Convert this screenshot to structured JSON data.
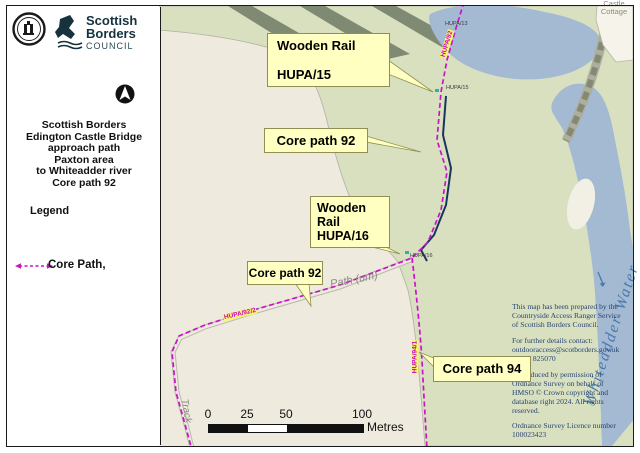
{
  "left_panel": {
    "logo": {
      "line1": "Scottish",
      "line2": "Borders",
      "council": "COUNCIL"
    },
    "title_lines": [
      "Scottish Borders",
      "Edington Castle Bridge",
      "approach path",
      "Paxton area",
      "to Whiteadder  river",
      "Core path 92"
    ],
    "legend_heading": "Legend",
    "legend_core_path_label": "Core Path,"
  },
  "map": {
    "callouts": {
      "wooden_rail_15": {
        "line1": "Wooden Rail",
        "line2": "HUPA/15"
      },
      "core_path_92_upper": {
        "label": "Core path 92"
      },
      "wooden_rail_16": {
        "line1": "Wooden Rail",
        "line2": "HUPA/16"
      },
      "core_path_92_lower": {
        "label": "Core path 92"
      },
      "core_path_94": {
        "label": "Core path 94"
      }
    },
    "path_tags": {
      "hupa_92": "HUPA/92",
      "hupa_92_2": "HUPA/92/2",
      "hupa_94_1": "HUPA/94/1"
    },
    "small_labels": {
      "hupa_13": "HUPA/13",
      "hupa_15": "HUPA/15",
      "hupa_16": "HUPA/16"
    },
    "place_labels": {
      "castle_cottage_line1": "Castle",
      "castle_cottage_line2": "Cottage",
      "path_um": "Path (um)",
      "track": "Track",
      "river_name": "Whiteadder Water"
    },
    "scale_bar": {
      "tick_0": "0",
      "tick_25": "25",
      "tick_50": "50",
      "tick_100": "100",
      "unit": "Metres"
    },
    "notes": {
      "prepared": "This map has been prepared by the Countryside Access Ranger Service of Scottish Borders Council.",
      "contact_intro": "For further details contact:",
      "contact_email": "outdooraccess@scotborders.gov.uk",
      "contact_phone": "01835 825070",
      "os_copyright": "Reproduced by permission of Ordnance Survey on behalf of HMSO © Crown copyright and database right 2024. All rights reserved.",
      "os_licence": "Ordnance Survey Licence number 100023423"
    },
    "colors": {
      "core_path": "#cc00cc",
      "wooden_rail": "#16365c",
      "callout_bg": "#ffffc2",
      "river": "#a4b9d2",
      "woodland": "#d9e0c0",
      "field": "#eeeadd"
    }
  }
}
